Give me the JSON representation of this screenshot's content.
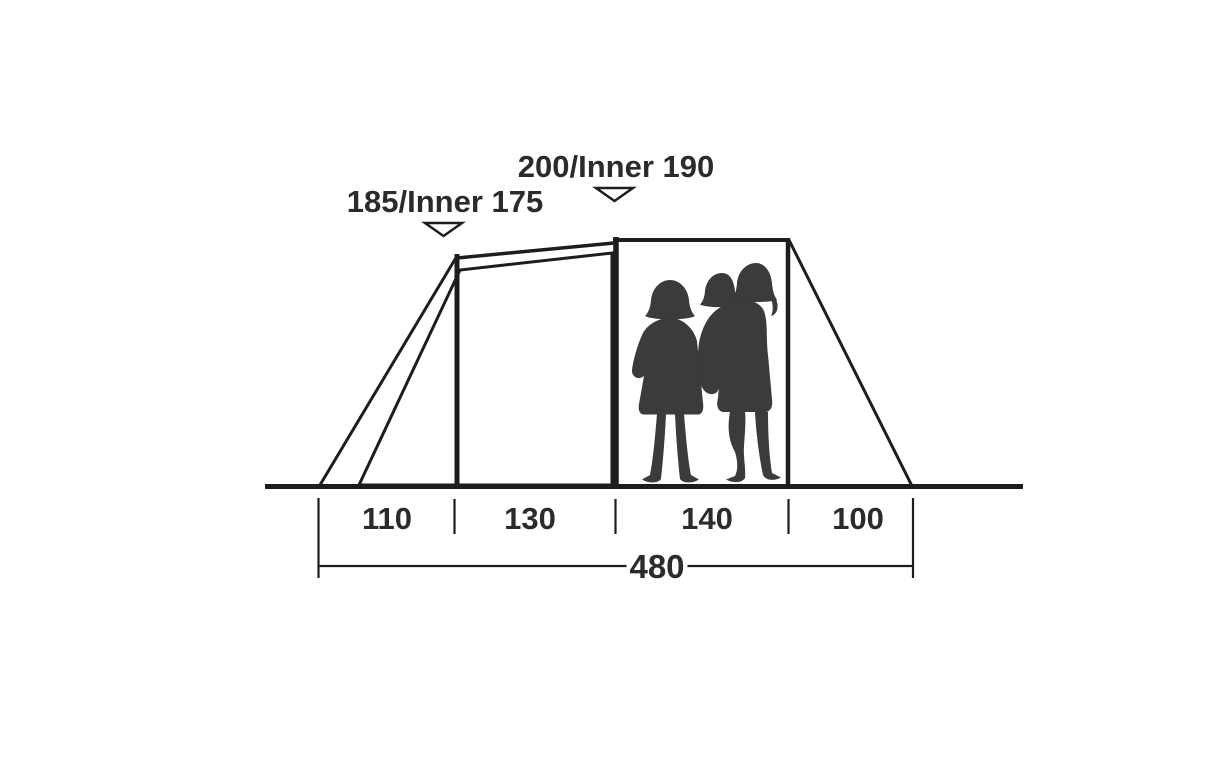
{
  "diagram": {
    "type": "tent-side-profile-dimension-diagram",
    "height_labels": {
      "front_peak": "185/Inner 175",
      "main_peak": "200/Inner 190"
    },
    "dimensions": {
      "unit_note": "values as printed, no unit shown",
      "sections": [
        {
          "label": "110"
        },
        {
          "label": "130"
        },
        {
          "label": "140"
        },
        {
          "label": "100"
        }
      ],
      "total": {
        "label": "480"
      }
    },
    "colors": {
      "line": "#1d1d1d",
      "inner_panel_fill": "#c7c8c7",
      "silhouette": "#3b3b3b",
      "marker_fill": "#ffffff",
      "text": "#2b2b2b",
      "background": "#ffffff"
    },
    "chart_data": {
      "type": "table",
      "title": "Tent profile dimensions",
      "columns": [
        "segment",
        "value"
      ],
      "rows": [
        [
          "front vestibule width",
          110
        ],
        [
          "front bedroom width",
          130
        ],
        [
          "living area width",
          140
        ],
        [
          "rear vestibule width",
          100
        ],
        [
          "total length",
          480
        ],
        [
          "front peak height / inner",
          "185 / 175"
        ],
        [
          "main peak height / inner",
          "200 / 190"
        ]
      ]
    }
  }
}
